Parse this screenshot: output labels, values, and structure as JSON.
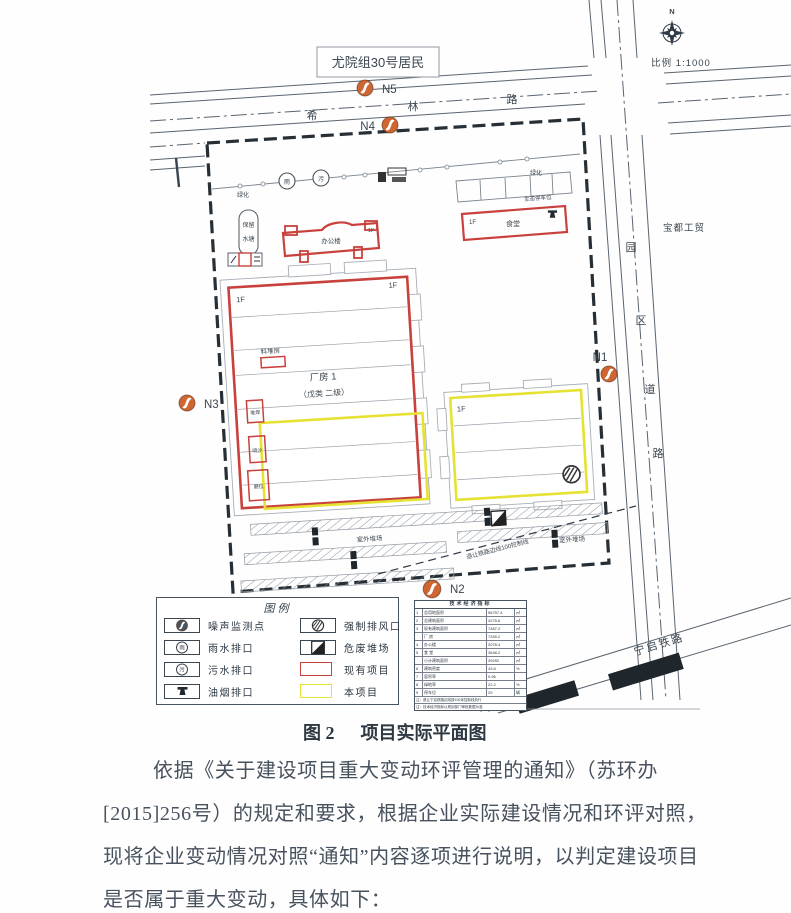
{
  "figure": {
    "north_label": "N",
    "scale_label": "比例 1:1000",
    "resident_box": "尤院组30号居民",
    "company_label": "宝都工贸",
    "road_xilin": {
      "c1": "希",
      "c2": "林",
      "c3": "路"
    },
    "road_park": {
      "c1": "园",
      "c2": "区",
      "c3": "道",
      "c4": "路"
    },
    "railway_label": "宁启铁路",
    "setback_label": "退让铁路边线100控制线",
    "green_label_1": "绿化",
    "green_label_2": "绿化",
    "eco_parking_label": "生态停车位",
    "rain_char": "雨",
    "sewage_char": "污",
    "pond_line1": "保留",
    "pond_line2": "水塘",
    "office_label": "办公楼",
    "office_floor": "1F",
    "canteen_label": "食堂",
    "canteen_floor": "1F",
    "factory1_name": "厂房 1",
    "factory1_class": "（戊类 二级）",
    "factory1_floor_left": "1F",
    "factory1_floor_right": "1F",
    "factory2_floor": "1F",
    "stockroom_label": "料堆房",
    "room_labels": [
      "堆焊",
      "喷沙",
      "磨位"
    ],
    "yard_label_1": "室外堆场",
    "yard_label_2": "室外堆场",
    "monitor_points": [
      {
        "id": "N1"
      },
      {
        "id": "N2"
      },
      {
        "id": "N3"
      },
      {
        "id": "N4"
      },
      {
        "id": "N5"
      }
    ],
    "monitor_color": "#cf6531"
  },
  "legend": {
    "title": "图例",
    "rain_char": "雨",
    "sewage_char": "污",
    "existing_color": "#c8413c",
    "project_color": "#e6e233",
    "items": [
      {
        "label": "噪声监测点"
      },
      {
        "label": "雨水排口"
      },
      {
        "label": "污水排口"
      },
      {
        "label": "油烟排口"
      },
      {
        "label": "强制排风口"
      },
      {
        "label": "危废堆场"
      },
      {
        "label": "现有项目"
      },
      {
        "label": "本项目"
      }
    ]
  },
  "indicator_table": {
    "title": "技术经济指标",
    "rows": [
      {
        "n": "1",
        "name": "总用地面积",
        "val": "56757.4",
        "unit": "㎡"
      },
      {
        "n": "2",
        "name": "总建筑面积",
        "val": "4275.6",
        "unit": "㎡"
      },
      {
        "n": "3",
        "name": "现有建筑面积",
        "val": "7487.2",
        "unit": "㎡"
      },
      {
        "n": "",
        "name": "厂 房",
        "val": "7345.2",
        "unit": "㎡"
      },
      {
        "n": "4",
        "name": "办公楼",
        "val": "2078.4",
        "unit": "㎡"
      },
      {
        "n": "5",
        "name": "食 堂",
        "val": "3648.2",
        "unit": "㎡"
      },
      {
        "n": "",
        "name": "小计建筑面积",
        "val": "39292",
        "unit": "㎡"
      },
      {
        "n": "6",
        "name": "建筑密度",
        "val": "43.8",
        "unit": "%"
      },
      {
        "n": "7",
        "name": "容积率",
        "val": "0.96",
        "unit": ""
      },
      {
        "n": "8",
        "name": "绿地率",
        "val": "22.2",
        "unit": "%"
      },
      {
        "n": "9",
        "name": "停车位",
        "val": "29",
        "unit": "辆"
      }
    ],
    "notes": [
      "注：退让宁启铁路边线按100米控制线执行",
      "注：技术经济指标以规划部门审批数据为准"
    ]
  },
  "caption": {
    "fig_no": "图 2",
    "title": "项目实际平面图"
  },
  "paragraph": {
    "lines": [
      "依据《关于建设项目重大变动环评管理的通知》（苏环办",
      "[2015]256号）的规定和要求，根据企业实际建设情况和环评对照，",
      "现将企业变动情况对照“通知”内容逐项进行说明，以判定建设项目",
      "是否属于重大变动，具体如下："
    ]
  }
}
